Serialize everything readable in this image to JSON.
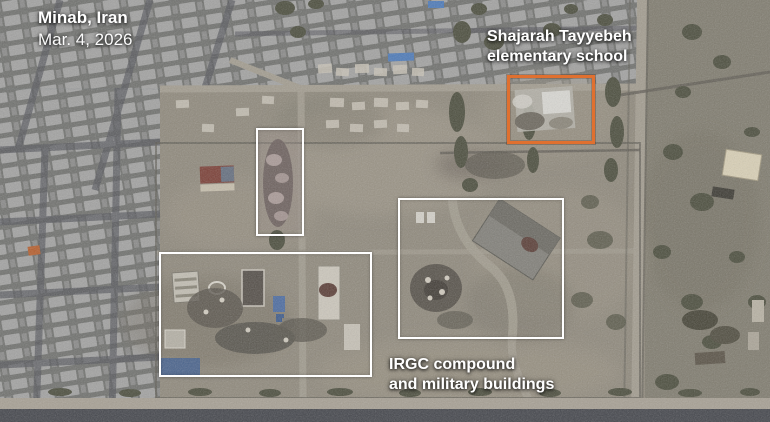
{
  "meta": {
    "location": "Minab, Iran",
    "date": "Mar. 4, 2026"
  },
  "annotations": {
    "school": {
      "line1": "Shajarah Tayyebeh",
      "line2": "elementary school"
    },
    "irgc": {
      "line1": "IRGC compound",
      "line2": "and military buildings"
    }
  },
  "colors": {
    "school_box": "#e0702f",
    "strike_box": "#ffffff",
    "label_text": "#ffffff"
  }
}
